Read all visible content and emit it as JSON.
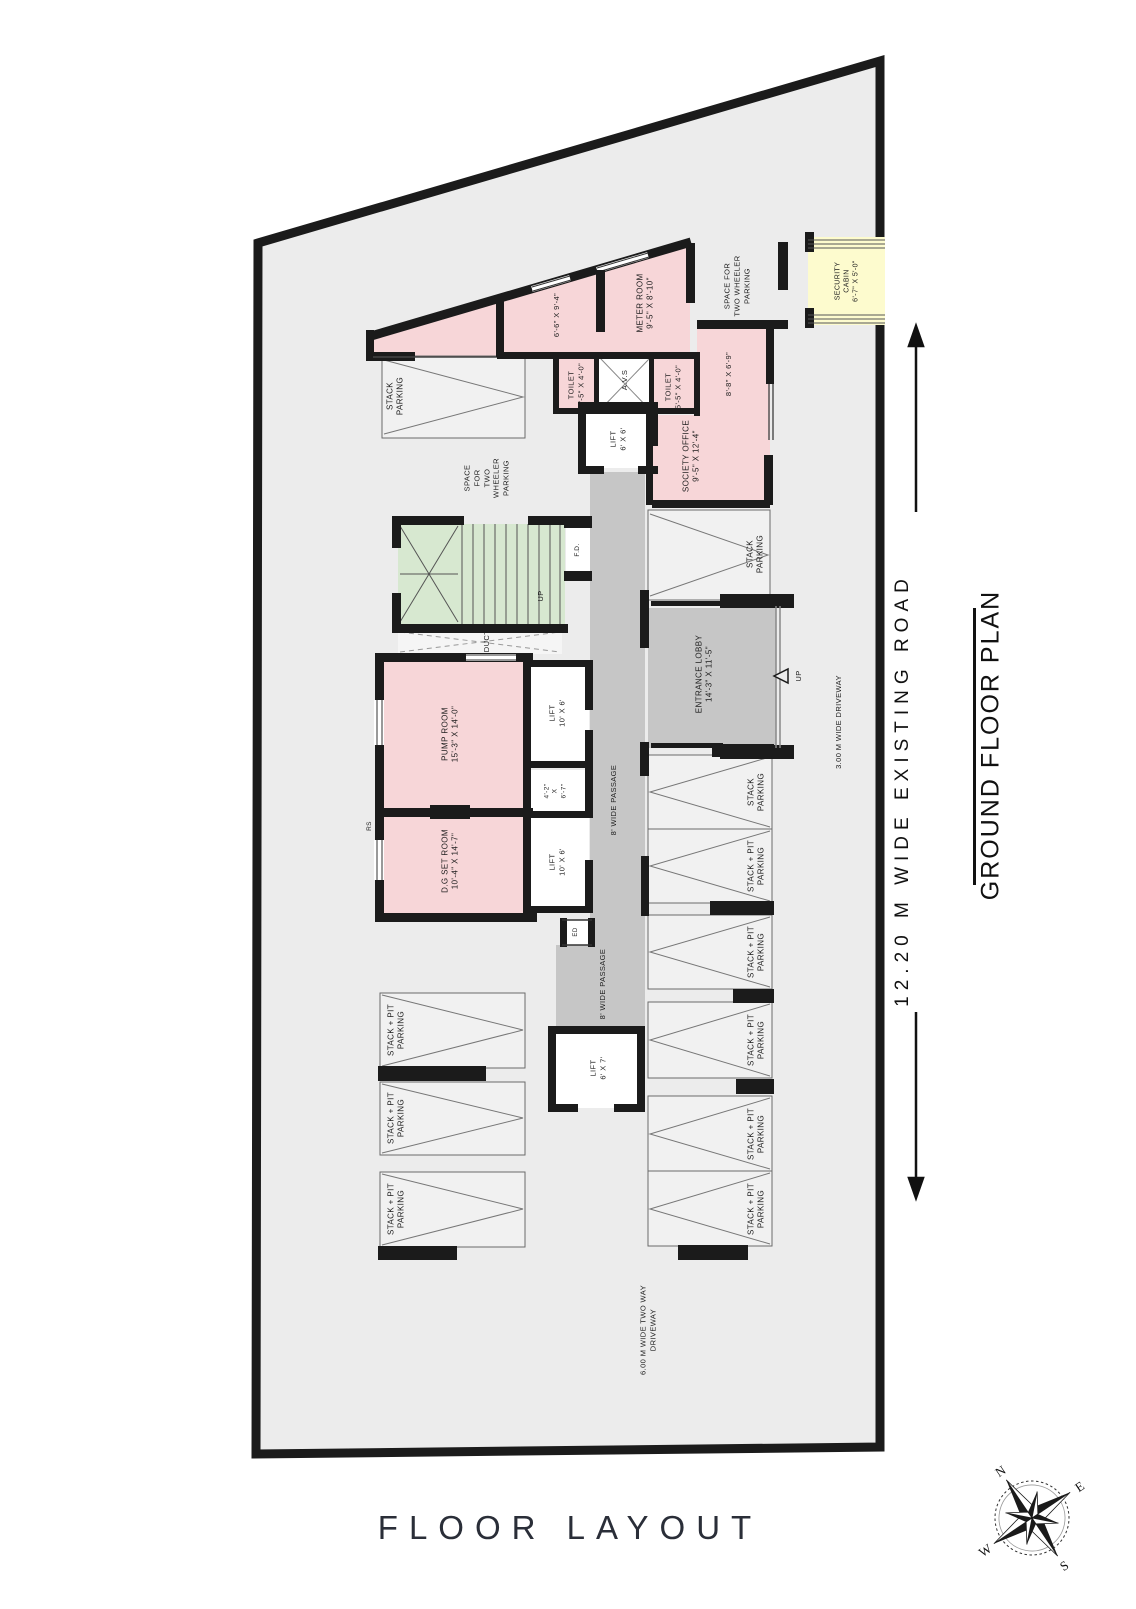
{
  "page": {
    "floor_layout_title": "FLOOR LAYOUT"
  },
  "side": {
    "road_label": "12.20 M WIDE EXISTING ROAD",
    "plan_title": "GROUND FLOOR PLAN"
  },
  "compass": {
    "n": "N",
    "e": "E",
    "s": "S",
    "w": "W"
  },
  "colors": {
    "plot_fill": "#ececec",
    "wall": "#1b1b1b",
    "room_pink": "#f7d6d8",
    "stairs_green": "#d7e8d0",
    "cabin_yellow": "#fdfbce",
    "passage_gray": "#c6c6c6",
    "stall_fill": "#f1f1f1"
  },
  "labels": [
    {
      "id": "stack-parking-topleft",
      "x": 396,
      "y": 396,
      "size": 8,
      "lines": [
        "STACK",
        "PARKING"
      ]
    },
    {
      "id": "room-6-6-dims",
      "x": 557,
      "y": 315,
      "size": 7.5,
      "lines": [
        "6'-6\" X 9'-4\""
      ]
    },
    {
      "id": "meter-room",
      "x": 646,
      "y": 303,
      "size": 8,
      "lines": [
        "METER ROOM",
        "9'-5\" X 8'-10\""
      ]
    },
    {
      "id": "two-wheeler-top",
      "x": 737,
      "y": 286,
      "size": 7.5,
      "lines": [
        "SPACE FOR",
        "TWO WHEELER",
        "PARKING"
      ]
    },
    {
      "id": "security-cabin",
      "x": 847,
      "y": 281,
      "size": 7,
      "lines": [
        "SECURITY",
        "CABIN",
        "6'-7\" X 5'-0\""
      ]
    },
    {
      "id": "toilet-1",
      "x": 576,
      "y": 385,
      "size": 7.5,
      "lines": [
        "TOILET",
        "5'-5\" X 4'-0\""
      ]
    },
    {
      "id": "avs",
      "x": 625,
      "y": 380,
      "size": 7.5,
      "lines": [
        "A.V.S"
      ]
    },
    {
      "id": "toilet-2",
      "x": 673,
      "y": 387,
      "size": 7.5,
      "lines": [
        "TOILET",
        "5'-5\" X 4'-0\""
      ]
    },
    {
      "id": "room-8-8-dims",
      "x": 729,
      "y": 374,
      "size": 7.5,
      "lines": [
        "8'-8\" X 6'-9\""
      ]
    },
    {
      "id": "lift-6x6",
      "x": 618,
      "y": 439,
      "size": 7.5,
      "lines": [
        "LIFT",
        "6' X 6'"
      ]
    },
    {
      "id": "society-office",
      "x": 692,
      "y": 456,
      "size": 8,
      "lines": [
        "SOCIETY OFFICE",
        "9'-5\" X 12'-4\""
      ]
    },
    {
      "id": "stack-parking-mid",
      "x": 756,
      "y": 554,
      "size": 8,
      "lines": [
        "STACK",
        "PARKING"
      ]
    },
    {
      "id": "two-wheeler-mid",
      "x": 487,
      "y": 478,
      "size": 7.5,
      "lines": [
        "SPACE",
        "FOR",
        "TWO",
        "WHEELER",
        "PARKING"
      ]
    },
    {
      "id": "fd",
      "x": 578,
      "y": 550,
      "size": 6.5,
      "lines": [
        "F.D."
      ]
    },
    {
      "id": "stairs-up",
      "x": 541,
      "y": 596,
      "size": 7.5,
      "lines": [
        "UP"
      ]
    },
    {
      "id": "duct",
      "x": 487,
      "y": 641,
      "size": 7.5,
      "lines": [
        "DUCT"
      ]
    },
    {
      "id": "pump-room",
      "x": 451,
      "y": 734,
      "size": 8,
      "lines": [
        "PUMP ROOM",
        "15'-3\" X 14'-0\""
      ]
    },
    {
      "id": "lift-10x6-upper",
      "x": 557,
      "y": 713,
      "size": 7.5,
      "lines": [
        "LIFT",
        "10' X 6'"
      ]
    },
    {
      "id": "room-4-2",
      "x": 556,
      "y": 791,
      "size": 6.5,
      "lines": [
        "4'-2\"",
        "X",
        "6'-7\""
      ]
    },
    {
      "id": "lift-10x6-lower",
      "x": 557,
      "y": 862,
      "size": 7.5,
      "lines": [
        "LIFT",
        "10' X 6'"
      ]
    },
    {
      "id": "dg-set-room",
      "x": 451,
      "y": 861,
      "size": 8,
      "lines": [
        "D.G SET ROOM",
        "10'-4\" X 14'-7\""
      ]
    },
    {
      "id": "rs",
      "x": 370,
      "y": 826,
      "size": 6.5,
      "lines": [
        "RS"
      ]
    },
    {
      "id": "ed",
      "x": 577,
      "y": 932,
      "size": 6,
      "lines": [
        "ED"
      ]
    },
    {
      "id": "passage-upper",
      "x": 614,
      "y": 800,
      "size": 7.5,
      "lines": [
        "8' WIDE PASSAGE"
      ]
    },
    {
      "id": "passage-lower",
      "x": 603,
      "y": 984,
      "size": 7.5,
      "lines": [
        "8' WIDE PASSAGE"
      ]
    },
    {
      "id": "entrance-lobby",
      "x": 705,
      "y": 674,
      "size": 8,
      "lines": [
        "ENTRANCE LOBBY",
        "14'-3\" X 11'-5\""
      ]
    },
    {
      "id": "entrance-up",
      "x": 799,
      "y": 676,
      "size": 7.5,
      "lines": [
        "UP"
      ]
    },
    {
      "id": "driveway-3m",
      "x": 839,
      "y": 722,
      "size": 7.5,
      "lines": [
        "3.00 M WIDE DRIVEWAY"
      ]
    },
    {
      "id": "right-stall-1",
      "x": 757,
      "y": 792,
      "size": 8,
      "lines": [
        "STACK",
        "PARKING"
      ]
    },
    {
      "id": "right-stall-2",
      "x": 757,
      "y": 866,
      "size": 8,
      "lines": [
        "STACK + PIT",
        "PARKING"
      ]
    },
    {
      "id": "right-stall-3",
      "x": 757,
      "y": 952,
      "size": 8,
      "lines": [
        "STACK + PIT",
        "PARKING"
      ]
    },
    {
      "id": "right-stall-4",
      "x": 757,
      "y": 1040,
      "size": 8,
      "lines": [
        "STACK + PIT",
        "PARKING"
      ]
    },
    {
      "id": "right-stall-5",
      "x": 757,
      "y": 1134,
      "size": 8,
      "lines": [
        "STACK + PIT",
        "PARKING"
      ]
    },
    {
      "id": "right-stall-6",
      "x": 757,
      "y": 1209,
      "size": 8,
      "lines": [
        "STACK + PIT",
        "PARKING"
      ]
    },
    {
      "id": "left-stall-1",
      "x": 397,
      "y": 1030,
      "size": 8,
      "lines": [
        "STACK + PIT",
        "PARKING"
      ]
    },
    {
      "id": "left-stall-2",
      "x": 397,
      "y": 1118,
      "size": 8,
      "lines": [
        "STACK + PIT",
        "PARKING"
      ]
    },
    {
      "id": "left-stall-3",
      "x": 397,
      "y": 1209,
      "size": 8,
      "lines": [
        "STACK + PIT",
        "PARKING"
      ]
    },
    {
      "id": "lift-6x7",
      "x": 598,
      "y": 1068,
      "size": 7.5,
      "lines": [
        "LIFT",
        "6' X 7'"
      ]
    },
    {
      "id": "driveway-6m",
      "x": 648,
      "y": 1330,
      "size": 7.5,
      "lines": [
        "6.00 M WIDE TWO WAY",
        "DRIVEWAY"
      ]
    }
  ]
}
